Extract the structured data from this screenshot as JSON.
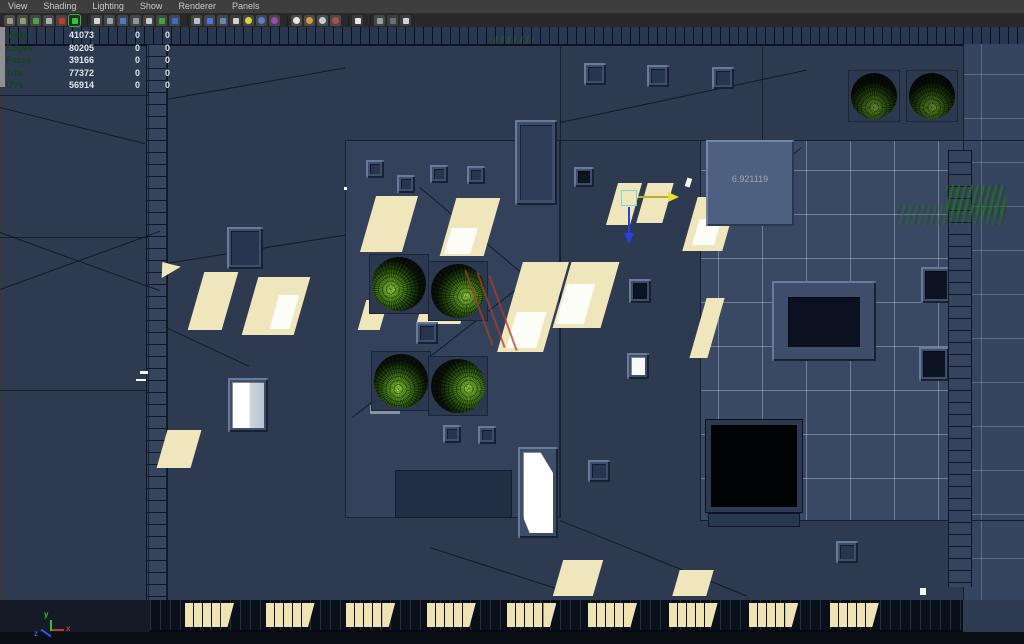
{
  "menu_bar": {
    "items": [
      "View",
      "Shading",
      "Lighting",
      "Show",
      "Renderer",
      "Panels"
    ]
  },
  "toolbar": {
    "icons": [
      {
        "name": "tumble-tool-icon",
        "tile": "#4a4a46",
        "dot": "#9b9b84"
      },
      {
        "name": "track-tool-icon",
        "tile": "#4a4a46",
        "dot": "#8f9b7a"
      },
      {
        "name": "image-plane-icon",
        "tile": "#3f4a3f",
        "dot": "#4fa04f"
      },
      {
        "name": "mesh-display-icon",
        "tile": "#474747",
        "dot": "#aab2bc"
      },
      {
        "name": "marker-icon",
        "tile": "#4a4440",
        "dot": "#c23b28"
      },
      {
        "name": "active-tool-icon",
        "tile": "#233023",
        "dot": "#35c23c",
        "border": "#3fae46"
      },
      {
        "name": "sep"
      },
      {
        "name": "film-gate-icon",
        "tile": "#454545",
        "dot": "#d6d6d6"
      },
      {
        "name": "resolution-gate-icon",
        "tile": "#454545",
        "dot": "#9aa2ac"
      },
      {
        "name": "gate-mask-icon",
        "tile": "#454545",
        "dot": "#4a7ad2"
      },
      {
        "name": "field-chart-icon",
        "tile": "#454545",
        "dot": "#8e96a4"
      },
      {
        "name": "safe-action-icon",
        "tile": "#454545",
        "dot": "#c9ced6"
      },
      {
        "name": "safe-title-icon",
        "tile": "#3f4a3f",
        "dot": "#46a046"
      },
      {
        "name": "hud-text-icon",
        "tile": "#454545",
        "dot": "#3a6ad8"
      },
      {
        "name": "sep"
      },
      {
        "name": "wireframe-mode-icon",
        "tile": "#454545",
        "dot": "#b9c0c9"
      },
      {
        "name": "shaded-mode-icon",
        "tile": "#454545",
        "dot": "#4a78d8"
      },
      {
        "name": "textured-mode-icon",
        "tile": "#454545",
        "dot": "#6a86b8"
      },
      {
        "name": "use-default-material-icon",
        "tile": "#3c3c3c",
        "dot": "#d2d2d2"
      },
      {
        "name": "lighting-all-icon",
        "tile": "#454545",
        "dot": "#d8d83a",
        "round": true
      },
      {
        "name": "shadows-icon",
        "tile": "#454545",
        "dot": "#5a7ad8",
        "round": true
      },
      {
        "name": "occlusion-icon",
        "tile": "#454545",
        "dot": "#9a4ab2",
        "round": true
      },
      {
        "name": "sep"
      },
      {
        "name": "xray-icon",
        "tile": "#4a4a4a",
        "dot": "#e6e6e6",
        "round": true
      },
      {
        "name": "xray-joints-icon",
        "tile": "#4a4a4a",
        "dot": "#d89a3a",
        "round": true
      },
      {
        "name": "exposure-icon",
        "tile": "#4a4a4a",
        "dot": "#c8ccd2",
        "round": true
      },
      {
        "name": "gamma-icon",
        "tile": "#4a4a4a",
        "dot": "#b24a4a",
        "round": true
      },
      {
        "name": "sep"
      },
      {
        "name": "select-cursor-icon",
        "tile": "#3c3c3c",
        "dot": "#e8e8e8"
      },
      {
        "name": "sep"
      },
      {
        "name": "isolate-select-icon",
        "tile": "#454545",
        "dot": "#9aa0aa"
      },
      {
        "name": "isolate-off-icon",
        "tile": "#3c3c3c",
        "dot": "#6a7076"
      },
      {
        "name": "share-view-icon",
        "tile": "#3c3c3c",
        "dot": "#d0d4da"
      }
    ]
  },
  "hud": {
    "rows": [
      {
        "label": "Verts",
        "total": "41073",
        "selected": "0",
        "component": "0"
      },
      {
        "label": "Edges",
        "total": "80205",
        "selected": "0",
        "component": "0"
      },
      {
        "label": "Faces",
        "total": "39166",
        "selected": "0",
        "component": "0"
      },
      {
        "label": "Tris",
        "total": "77372",
        "selected": "0",
        "component": "0"
      },
      {
        "label": "UVs",
        "total": "56914",
        "selected": "0",
        "component": "0"
      }
    ]
  },
  "scene": {
    "measurement": "6.921119"
  },
  "axis": {
    "x": "x",
    "y": "y",
    "z": "z"
  },
  "bottom_windows": {
    "group_count": 9,
    "panes_per_group": 4
  },
  "colors": {
    "roof_base": "#2e3a4f",
    "terrace": "#3a4963",
    "sunlight": "#efe6bc",
    "tree_green": "#67a827",
    "selection_green": "#2a702e",
    "manip_x_active": "#e8e13a",
    "manip_z": "#2a3ee8",
    "hud_text": "#dfe5ec",
    "hud_label_green": "#17421f"
  }
}
